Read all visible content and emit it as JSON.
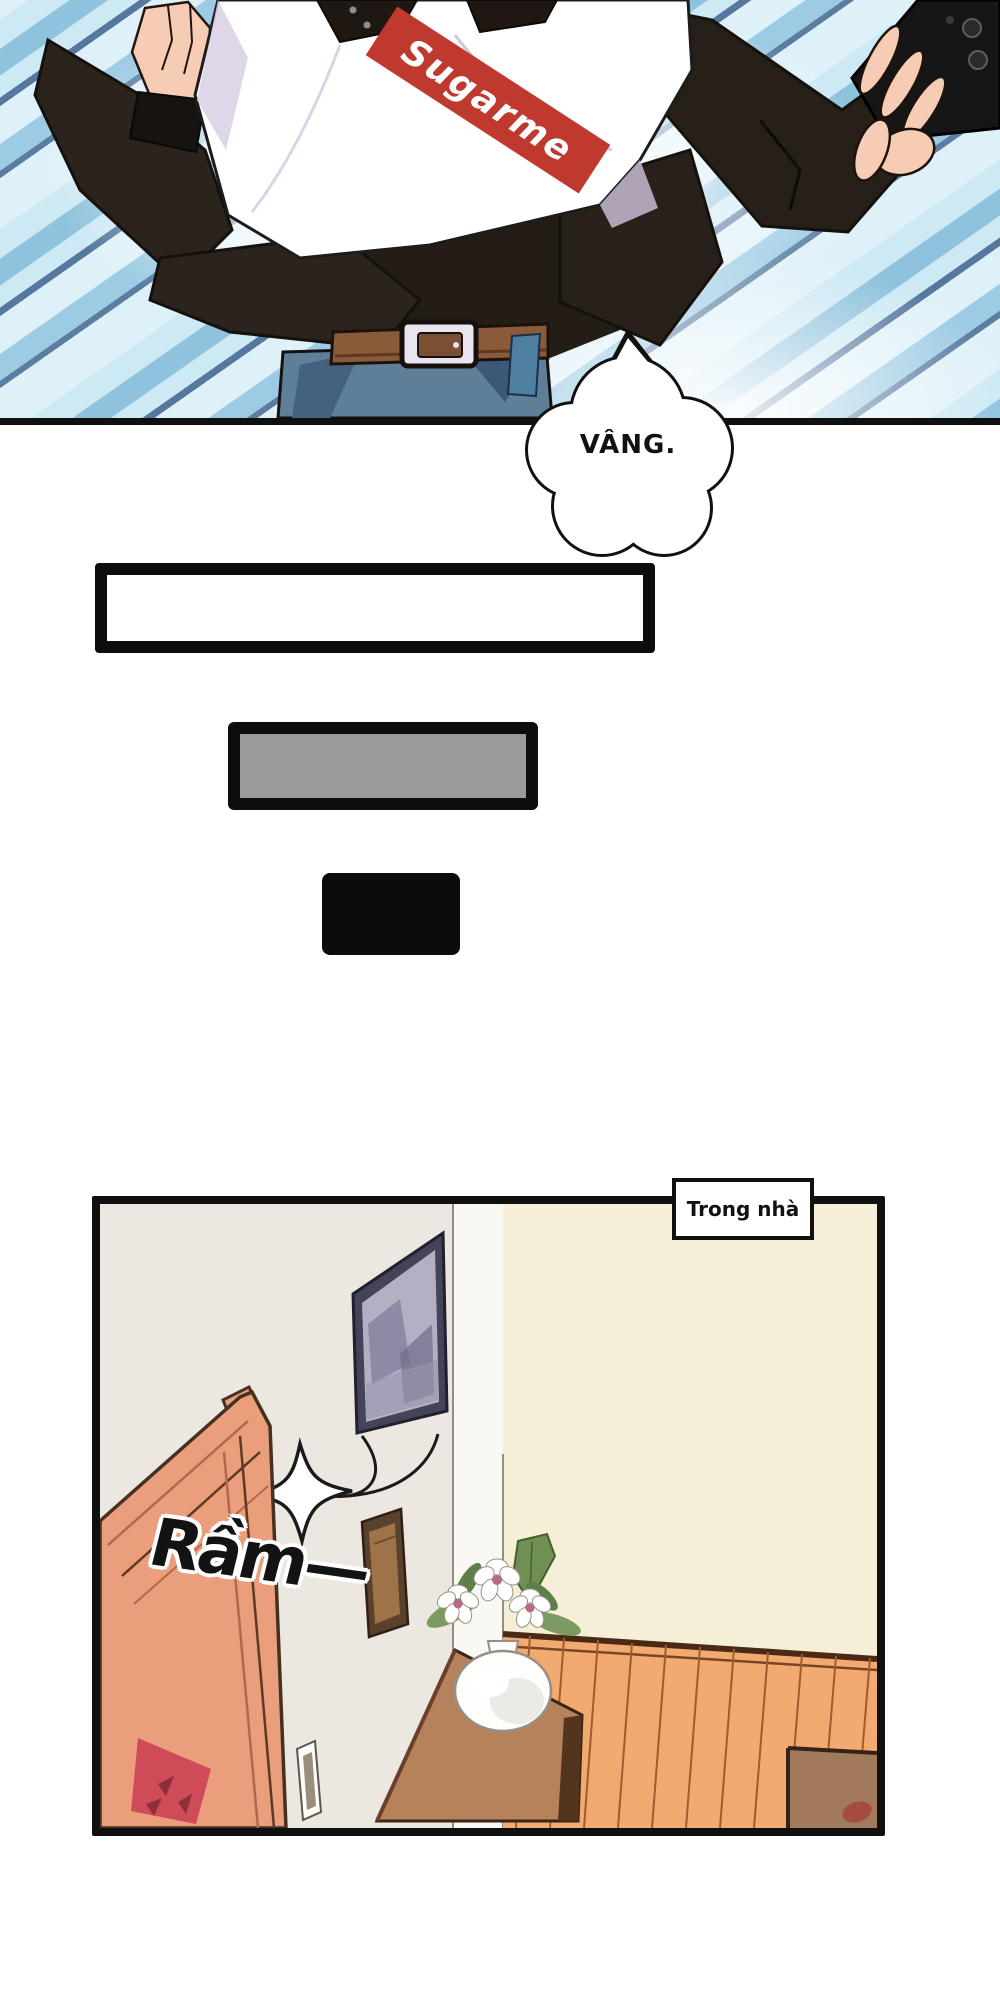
{
  "page": {
    "background": "#ffffff"
  },
  "top_panel": {
    "shirt_logo_text": "Sugarme",
    "colors": {
      "stripe_base": "#dff1f8",
      "stripe_light": "#cde9f4",
      "stripe_mid": "#8fc2dd",
      "stripe_dark": "#56789e",
      "jacket_black": "#2b241d",
      "shirt_white": "#ffffff",
      "shirt_shade": "#d9d0e4",
      "skin": "#f6cdb4",
      "jeans_blue": "#5f7f98",
      "jeans_shade": "#44617e",
      "belt_brown": "#8a5a39",
      "buckle_silver": "#e9e5ee",
      "logo_red": "#c0392f",
      "phone_black": "#161616",
      "panel_border": "#101010"
    }
  },
  "speech_bubble": {
    "text": "VÂNG.",
    "fill": "#ffffff",
    "outline": "#111111"
  },
  "placeholder_boxes": {
    "white_box": {
      "fill": "#ffffff",
      "border": "#0d0d0d"
    },
    "gray_box": {
      "fill": "#9a9a9a",
      "border": "#0d0d0d"
    },
    "black_box": {
      "fill": "#0c0c0c"
    }
  },
  "bottom_panel": {
    "caption": "Trong nhà",
    "sfx_text": "Rầm—",
    "colors": {
      "wall_left": "#ece7e0",
      "wall_right": "#f6efd8",
      "pillar": "#faf8f2",
      "door_salmon": "#eb9e7c",
      "door_line": "#b06a4a",
      "poster_red": "#ce4b57",
      "picture_frame": "#44435a",
      "picture_art": "#b3b0c4",
      "small_frame": "#59412c",
      "small_frame_inner": "#9d7347",
      "wainscot_orange": "#f3aa70",
      "wainscot_line": "#a05c2e",
      "cabinet_wood": "#b5825c",
      "cabinet_edge": "#53341f",
      "vase_white": "#fdfdfc",
      "leaf_green": "#7b9b63",
      "flower_center": "#b86a85",
      "furniture_brown": "#a1795b",
      "panel_border": "#101010"
    }
  }
}
